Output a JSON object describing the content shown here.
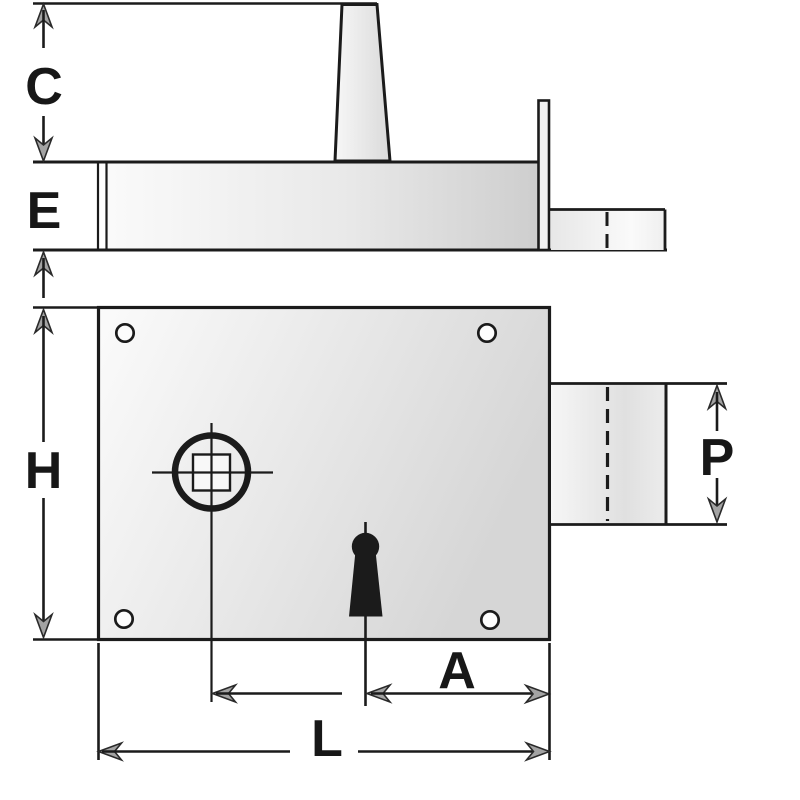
{
  "diagram": {
    "dimension_labels": {
      "c": "C",
      "e": "E",
      "h": "H",
      "p": "P",
      "a": "A",
      "l": "L"
    }
  },
  "colors": {
    "background": "#ffffff",
    "line": "#1b1b1b",
    "text": "#171717",
    "arrow-fill": "#a3a3a3",
    "arrow-stroke": "#2a2a2a",
    "metal-light": "#fbfbfb",
    "metal-dark": "#d2d2d2"
  }
}
